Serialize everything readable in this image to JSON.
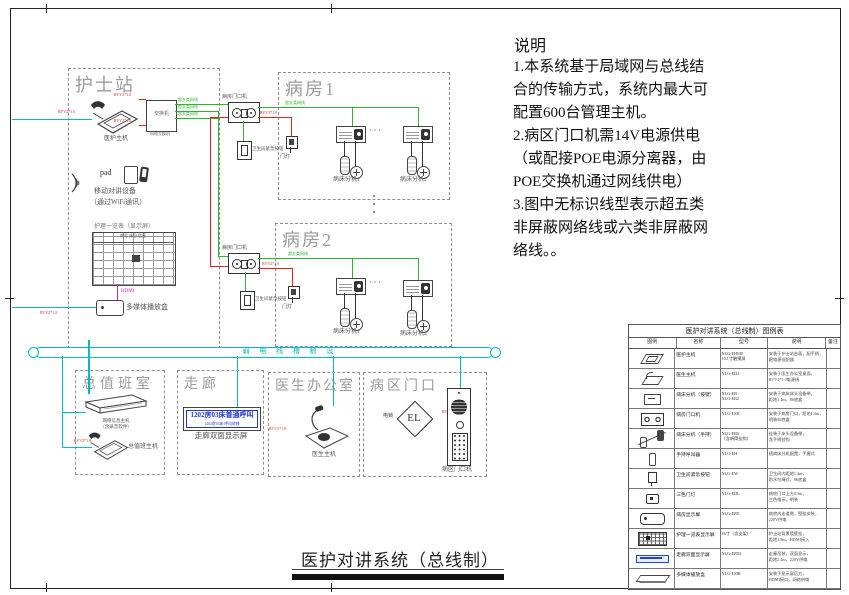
{
  "notes": {
    "title": "说明",
    "body": "1.本系统基于局域网与总线结\n合的传输方式，系统内最大可\n配置600台管理主机。\n2.病区门口机需14V电源供电\n（或配接POE电源分离器，由\nPOE交换机通过网线供电）\n3.图中无标识线型表示超五类\n非屏蔽网络线或六类非屏蔽网\n络线。。"
  },
  "main_title": "医护对讲系统（总线制）",
  "trunk_label": "弱 电 线 槽 敷 设",
  "nurse": {
    "title": "护士站",
    "host_label": "医护主机",
    "switch_text": "交换机",
    "switch_label": "网络交换机",
    "net_label": "超五类网线",
    "power_label": "RVV2*1.0",
    "pad": "pad",
    "wifi_line1": "移动对讲设备",
    "wifi_line2": "（通过WiFi通讯）",
    "board_title": "护理一览表（显示屏）",
    "board_header": "房号 床位 信息",
    "hdmi": "HDMI",
    "media_label": "多媒体播放盒"
  },
  "ward1": {
    "title": "病房1",
    "door_label": "病房门口机",
    "net_label": "超五类网线",
    "power_label": "RVV2*1.0",
    "toilet_label": "卫生间紧急按钮",
    "lamp_label": "门灯",
    "bed1": "病床分机1",
    "bed2": "病床分机2",
    "dots": "· · ·"
  },
  "ward2": {
    "title": "病房2",
    "door_label": "病房门口机",
    "net_label": "超五类网线",
    "power_label": "RVV2*1.0",
    "toilet_label": "卫生间紧急按钮",
    "lamp_label": "门灯",
    "bed1": "病床分机1",
    "bed2": "病床分机2",
    "dots": "· · ·"
  },
  "duty": {
    "title": "总值班室",
    "rack_line1": "网络信息主机",
    "rack_line2": "（含录音软件）",
    "phone_label": "总值班主机",
    "power_label": "RVV2*1.0"
  },
  "corridor": {
    "title": "走廊",
    "line1": "1202房03床普通呼叫",
    "line2": "1202房03床 呼叫转移",
    "label": "走廊双面显示屏"
  },
  "doctor": {
    "title": "医生办公室",
    "device_label": "医生主机",
    "power_label": "RVV2*1.0"
  },
  "entrance": {
    "title": "病区门口",
    "el": "EL",
    "lock_label": "电锁",
    "power_label": "RVV2*1.0",
    "station_label": "病区门口机"
  },
  "legend": {
    "title": "医护对讲系统（总线制）图例表",
    "headers": [
      "图例",
      "名称",
      "型号",
      "说明",
      "备注"
    ],
    "rows": [
      {
        "icon": "host",
        "name": "医护主机",
        "model": "NLG-EHM8\n10.1寸触摸屏",
        "desc": "安装于护士站台面，配手柄，\n配电源适配器",
        "remark": ""
      },
      {
        "icon": "doctor",
        "name": "医生主机",
        "model": "NLG-ED2",
        "desc": "安装于医生办公室桌面，\nRVV2*1.0电源线",
        "remark": ""
      },
      {
        "icon": "bedbtn",
        "name": "病床分机（按键）",
        "model": "NLG-EB\nNLG-EB2",
        "desc": "安装于病床床头设备带，\n距地1.4m，86底盒",
        "remark": ""
      },
      {
        "icon": "doorunit",
        "name": "病房门口机",
        "model": "NLG-EMC",
        "desc": "安装于病房门口，距地1.4m，\n明装86底盒",
        "remark": ""
      },
      {
        "icon": "handsets",
        "name": "病床分机（手持）",
        "model": "NLG-EBS\n（含听筒挂钩）",
        "desc": "挂装于床头设备带，\n含手柄挂钩",
        "remark": ""
      },
      {
        "icon": "handset",
        "name": "手持呼叫器",
        "model": "NLG-EH",
        "desc": "随病床分机配置，手握式",
        "remark": ""
      },
      {
        "icon": "toilet",
        "name": "卫生间紧急按钮",
        "model": "NLG-EW",
        "desc": "卫生间内距地1.4m，\n防水拉绳式，86底盒",
        "remark": ""
      },
      {
        "icon": "lamp",
        "name": "三色门灯",
        "model": "NLG-EDL",
        "desc": "病房门口上方0.3m，\n三色指示，明装",
        "remark": ""
      },
      {
        "icon": "display",
        "name": "病房显示屏",
        "model": "NLG-EPD",
        "desc": "病房内走道侧，壁挂安装，\n220V供电",
        "remark": ""
      },
      {
        "icon": "board",
        "name": "护理一览表显示屏",
        "model": "46寸（含支架）",
        "desc": "护士站背景墙壁挂，\n距地1.8m，HDMI接入",
        "remark": ""
      },
      {
        "icon": "corridorbar",
        "name": "走廊双面显示屏",
        "model": "NLG-EPD2",
        "desc": "走廊吊装，双面显示，\n距地2.4m，220V供电",
        "remark": ""
      },
      {
        "icon": "rack",
        "name": "多媒体播放盒",
        "model": "NLG-EMB",
        "desc": "安装于显示屏后方，\nHDMI接口，网络供电",
        "remark": ""
      },
      {
        "icon": "stationlock",
        "name": "病区门口机＋电锁",
        "model": "NLG-EMD、EL-280",
        "desc": "病区入口距地1.4m，\n配电控锁14V供电",
        "remark": ""
      }
    ]
  }
}
